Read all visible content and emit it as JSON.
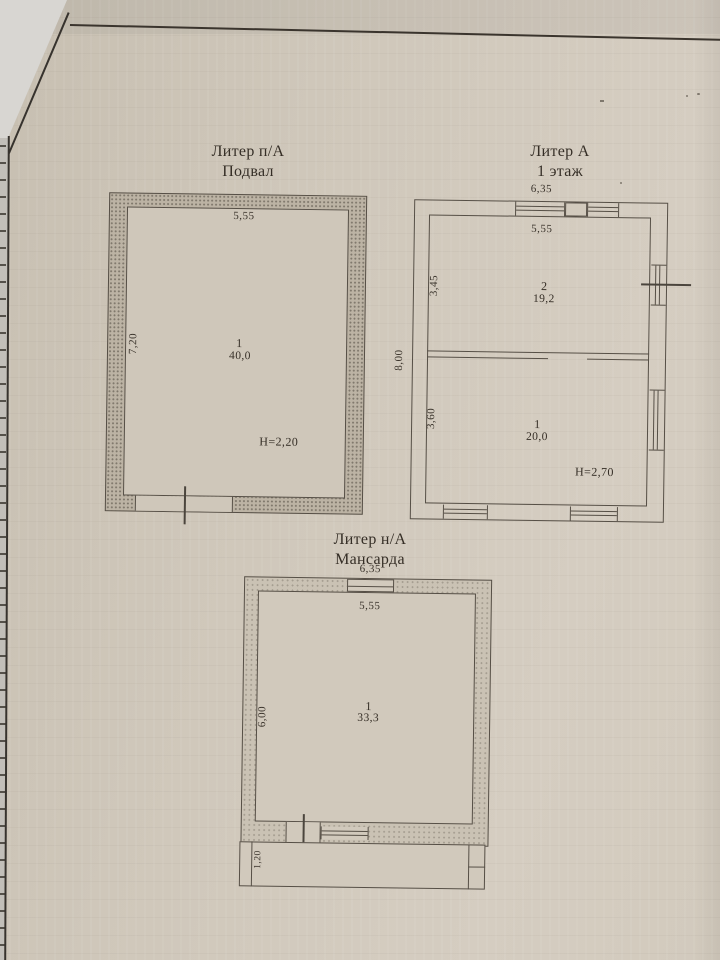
{
  "colors": {
    "paper": "#cfc7ba",
    "ink": "#3b342c",
    "wall_hatch": "#bcb3a4",
    "underlay": "#c2bfb9"
  },
  "plans": {
    "basement": {
      "title_line1": "Литер п/А",
      "title_line2": "Подвал",
      "dim_top": "5,55",
      "dim_left": "7,20",
      "room_number": "1",
      "room_area": "40,0",
      "height_note": "Н=2,20"
    },
    "floor1": {
      "title_line1": "Литер А",
      "title_line2": "1 этаж",
      "dim_top_outer": "6,35",
      "dim_top_inner": "5,55",
      "dim_left_outer": "8,00",
      "room2": {
        "number": "2",
        "area": "19,2",
        "dim_left": "3,45"
      },
      "room1": {
        "number": "1",
        "area": "20,0",
        "dim_left": "3,60"
      },
      "height_note": "Н=2,70"
    },
    "mansard": {
      "title_line1": "Литер н/А",
      "title_line2": "Мансарда",
      "dim_top_outer": "6,35",
      "dim_top_inner": "5,55",
      "dim_left": "6,00",
      "room_number": "1",
      "room_area": "33,3",
      "dim_bottom_strip": "1,20"
    }
  }
}
